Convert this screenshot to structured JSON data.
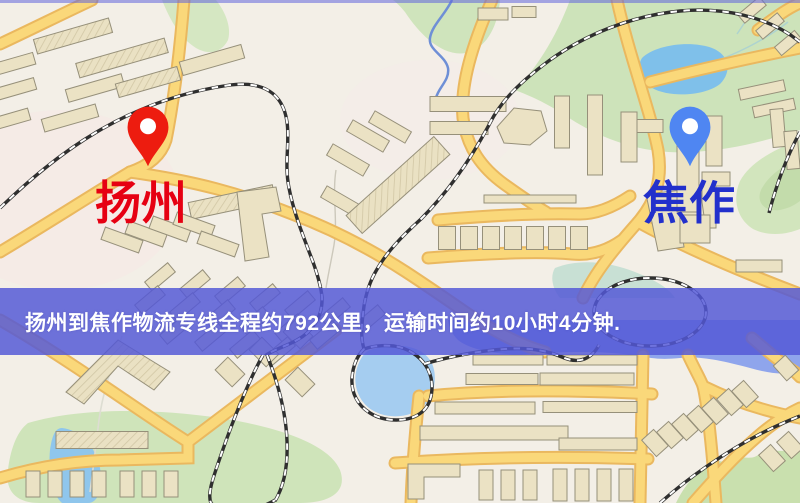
{
  "map": {
    "markers": [
      {
        "id": "origin",
        "label": "扬州",
        "pin_color": "#ed1c0f",
        "pin_hole_color": "#ffffff",
        "label_color": "#e60012",
        "icon": "location-pin-icon"
      },
      {
        "id": "destination",
        "label": "焦作",
        "pin_color": "#4f86f2",
        "pin_hole_color": "#ffffff",
        "label_color": "#2230cc",
        "icon": "location-pin-icon"
      }
    ]
  },
  "banner": {
    "text": "扬州到焦作物流专线全程约792公里，运输时间约10小时4分钟.",
    "origin": "扬州",
    "destination": "焦作",
    "distance": "792公里",
    "duration": "10小时4分钟",
    "bg_color": "#5458d6",
    "text_color": "#ffffff"
  },
  "palette": {
    "background": "#f3efe7",
    "road_fill": "#fad87a",
    "road_casing": "#eab85f",
    "railway": "#2f2f2f",
    "green_area": "#cfe4bc",
    "water": "#8fa5ec",
    "building": "#ebe2c4"
  }
}
